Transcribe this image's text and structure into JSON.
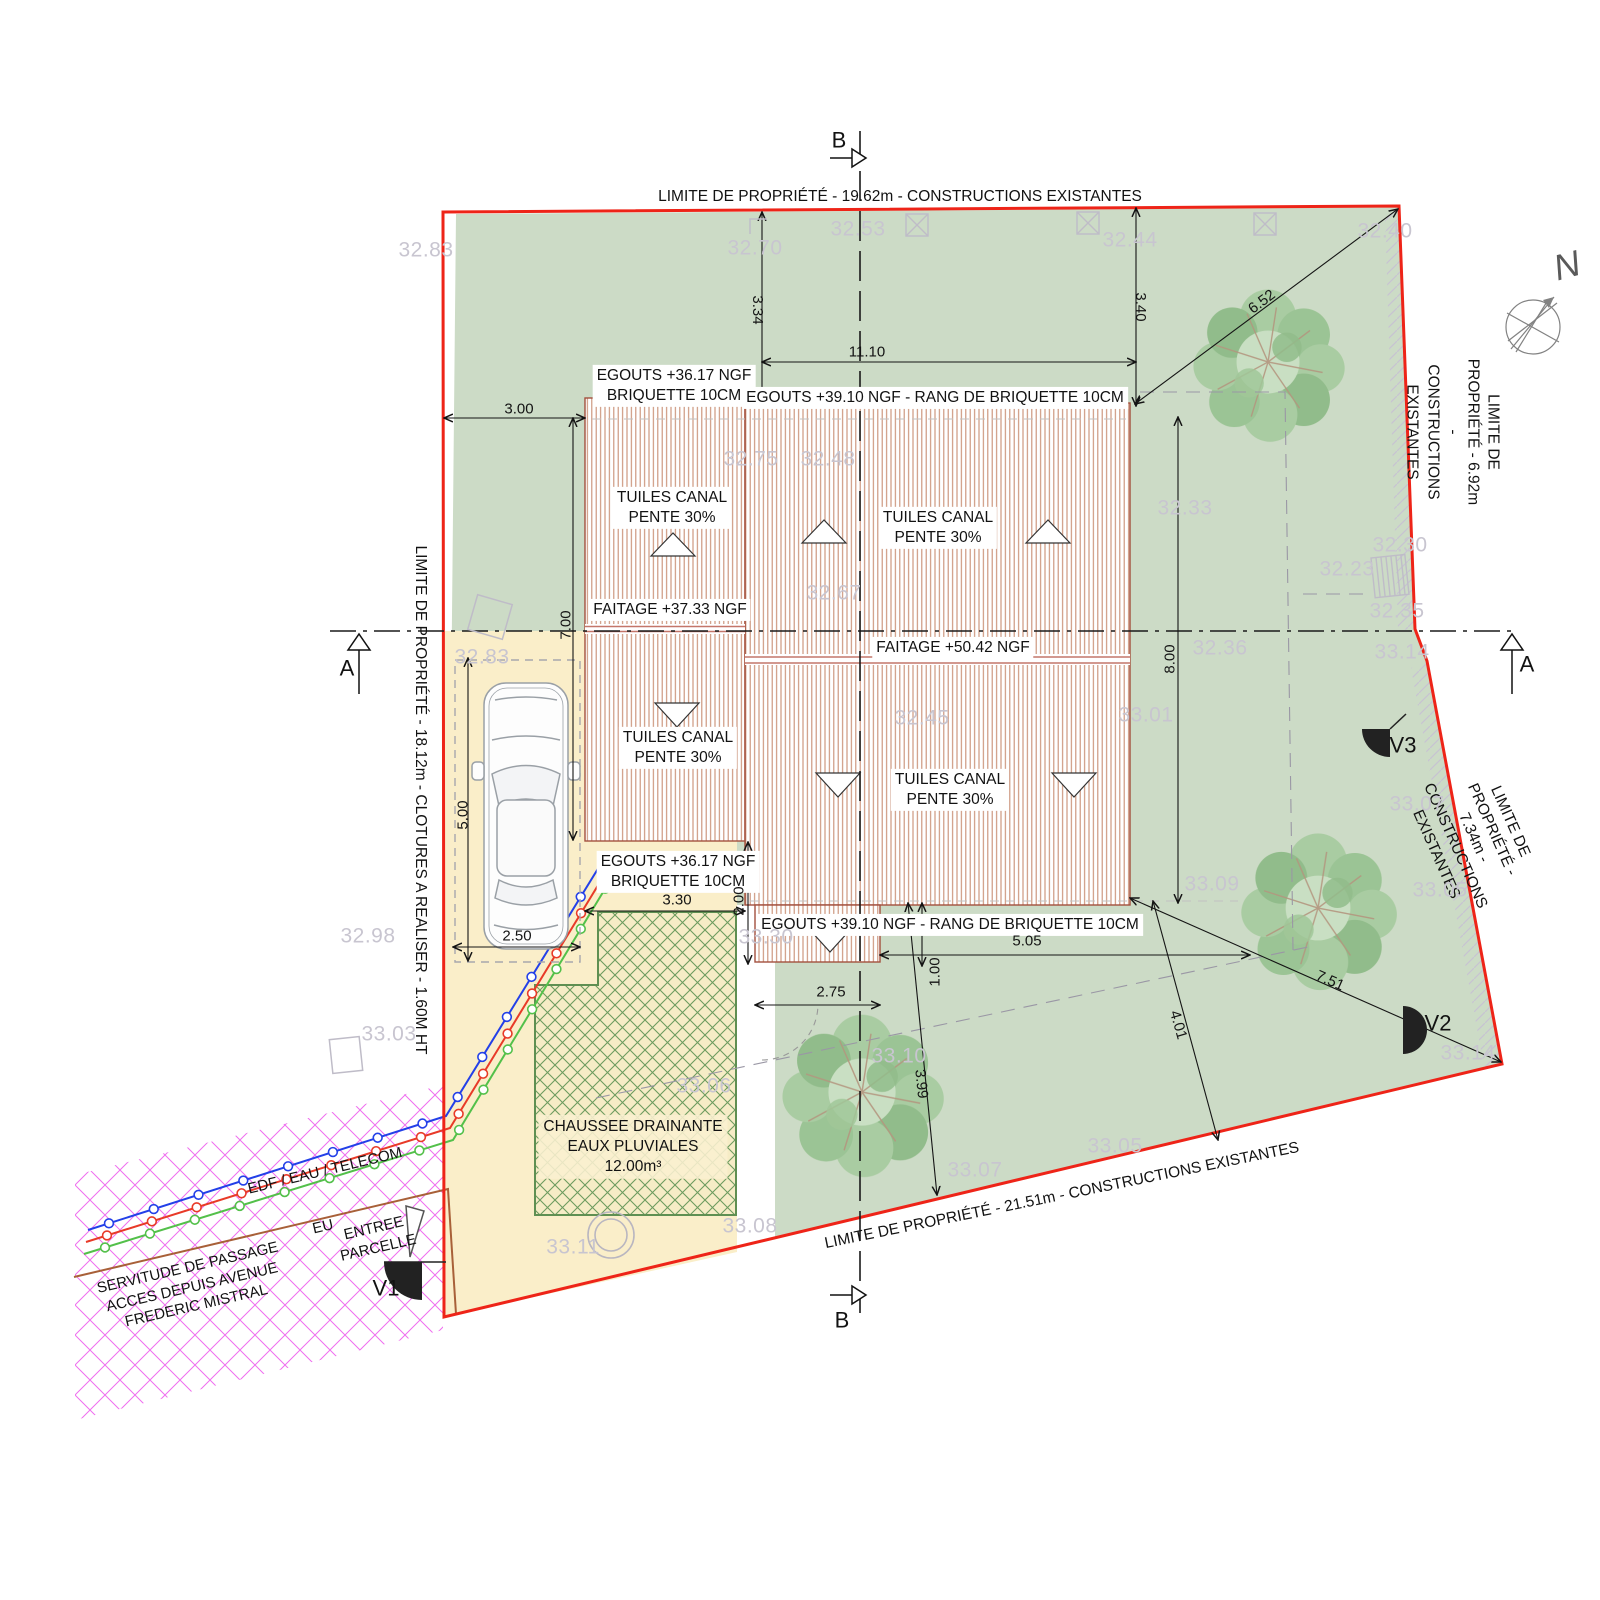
{
  "boundaries": {
    "top": "LIMITE DE PROPRIÉTÉ - 19.62m - CONSTRUCTIONS EXISTANTES",
    "left": "LIMITE DE PROPRIÉTÉ - 18.12m - CLOTURES A REALISER - 1.60M HT",
    "right_upper": "LIMITE DE PROPRIÉTÉ - 6.92m -\nCONSTRUCTIONS EXISTANTES",
    "right_lower": "LIMITE DE PROPRIÉTÉ - 7.34m -\nCONSTRUCTIONS EXISTANTES",
    "bottom": "LIMITE DE PROPRIÉTÉ - 21.51m - CONSTRUCTIONS EXISTANTES"
  },
  "roof": {
    "tuiles": "TUILES CANAL\nPENTE 30%",
    "egouts_low": "EGOUTS +36.17 NGF\nBRIQUETTE 10CM",
    "egouts_high": "EGOUTS +39.10 NGF - RANG DE BRIQUETTE 10CM",
    "faitage_low": "FAITAGE +37.33 NGF",
    "faitage_high": "FAITAGE +50.42 NGF"
  },
  "drainage": "CHAUSSEE DRAINANTE\nEAUX PLUVIALES\n12.00m³",
  "access": {
    "servitude": "SERVITUDE DE PASSAGE\nACCES DEPUIS AVENUE\nFREDERIC MISTRAL",
    "utilities": "EDF / EAU / TELECOM",
    "sewer": "EU",
    "entrance": "ENTREE\nPARCELLE"
  },
  "markers": {
    "v1": "V1",
    "v2": "V2",
    "v3": "V3",
    "section_a": "A",
    "section_b": "B",
    "north": "N"
  },
  "dimensions": [
    {
      "t": "3.00",
      "x": 519,
      "y": 409,
      "r": 0
    },
    {
      "t": "3.34",
      "x": 757,
      "y": 310,
      "r": 90
    },
    {
      "t": "3.40",
      "x": 1140,
      "y": 307,
      "r": 90
    },
    {
      "t": "11.10",
      "x": 867,
      "y": 352,
      "r": 0
    },
    {
      "t": "6.52",
      "x": 1262,
      "y": 302,
      "r": -37
    },
    {
      "t": "7.00",
      "x": 566,
      "y": 625,
      "r": -90
    },
    {
      "t": "8.00",
      "x": 1170,
      "y": 659,
      "r": -90
    },
    {
      "t": "5.00",
      "x": 463,
      "y": 815,
      "r": -90
    },
    {
      "t": "2.50",
      "x": 517,
      "y": 936,
      "r": 0
    },
    {
      "t": "3.30",
      "x": 677,
      "y": 900,
      "r": 0
    },
    {
      "t": "2.00",
      "x": 739,
      "y": 901,
      "r": -90
    },
    {
      "t": "2.75",
      "x": 831,
      "y": 992,
      "r": 0
    },
    {
      "t": "1.00",
      "x": 935,
      "y": 972,
      "r": -90
    },
    {
      "t": "5.05",
      "x": 1027,
      "y": 941,
      "r": 0
    },
    {
      "t": "3.99",
      "x": 921,
      "y": 1084,
      "r": 84
    },
    {
      "t": "4.01",
      "x": 1178,
      "y": 1025,
      "r": 74
    },
    {
      "t": "7.51",
      "x": 1330,
      "y": 981,
      "r": 24
    }
  ],
  "elevations": [
    {
      "t": "32.83",
      "x": 426,
      "y": 250
    },
    {
      "t": "32.70",
      "x": 755,
      "y": 248
    },
    {
      "t": "32.53",
      "x": 858,
      "y": 229
    },
    {
      "t": "32.44",
      "x": 1130,
      "y": 240
    },
    {
      "t": "32.40",
      "x": 1385,
      "y": 231
    },
    {
      "t": "32.75",
      "x": 751,
      "y": 459
    },
    {
      "t": "32.48",
      "x": 828,
      "y": 459
    },
    {
      "t": "32.67",
      "x": 834,
      "y": 593
    },
    {
      "t": "32.33",
      "x": 1185,
      "y": 508
    },
    {
      "t": "32.30",
      "x": 1400,
      "y": 545
    },
    {
      "t": "32.23",
      "x": 1347,
      "y": 569
    },
    {
      "t": "32.35",
      "x": 1397,
      "y": 611
    },
    {
      "t": "32.36",
      "x": 1220,
      "y": 648
    },
    {
      "t": "33.14",
      "x": 1402,
      "y": 652
    },
    {
      "t": "32.83",
      "x": 482,
      "y": 657
    },
    {
      "t": "32.45",
      "x": 922,
      "y": 718
    },
    {
      "t": "33.01",
      "x": 1146,
      "y": 715
    },
    {
      "t": "33.07",
      "x": 1417,
      "y": 804
    },
    {
      "t": "33.05",
      "x": 1440,
      "y": 890
    },
    {
      "t": "33.09",
      "x": 1212,
      "y": 884
    },
    {
      "t": "32.98",
      "x": 368,
      "y": 936
    },
    {
      "t": "33.03",
      "x": 389,
      "y": 1034
    },
    {
      "t": "33.30",
      "x": 766,
      "y": 937
    },
    {
      "t": "33.06",
      "x": 704,
      "y": 1086
    },
    {
      "t": "33.10",
      "x": 899,
      "y": 1056
    },
    {
      "t": "33.08",
      "x": 750,
      "y": 1226
    },
    {
      "t": "33.11",
      "x": 573,
      "y": 1247
    },
    {
      "t": "33.07",
      "x": 975,
      "y": 1170
    },
    {
      "t": "33.05",
      "x": 1115,
      "y": 1146
    },
    {
      "t": "33.14",
      "x": 1468,
      "y": 1053
    }
  ],
  "colors": {
    "boundary": "#ee2418",
    "lawn": "#ccdbc6",
    "driveway": "#faeec9",
    "roof_hatch": "#c98f74",
    "drain_hatch": "#6d9b5e",
    "servitude_hatch": "#ef6def",
    "elevation_text": "#c8c5d0",
    "utility_blue": "#2340e8",
    "utility_red": "#e83a28",
    "utility_green": "#53c04a",
    "utility_brown": "#a86038"
  }
}
